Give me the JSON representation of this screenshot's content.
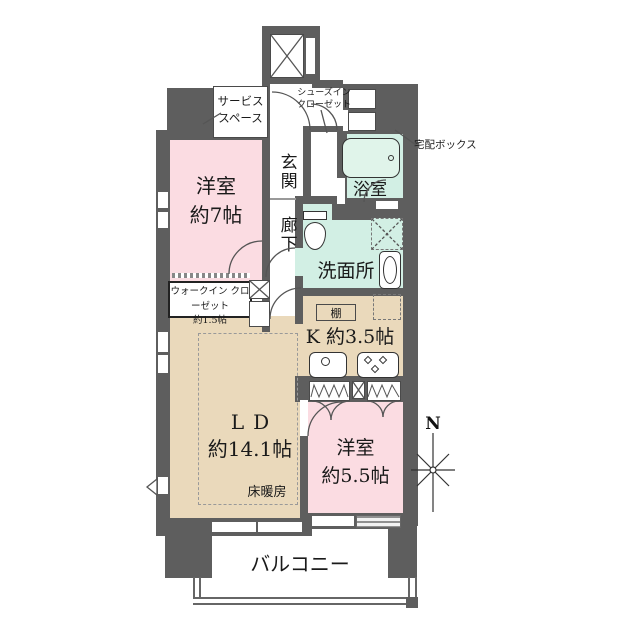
{
  "title": "apartment-floor-plan",
  "colors": {
    "wall": "#5e5e5e",
    "pink": "#fbdce2",
    "tan": "#ead9bb",
    "mint": "#d2efe4",
    "line": "#4a4a4a",
    "text": "#1a1a1a"
  },
  "labels": {
    "service_space": "サービス\nスペース",
    "shoes_in_closet": "シューズイン\nクローゼット",
    "entrance": "玄関",
    "delivery_box": "宅配ボックス",
    "bathroom": "浴室",
    "corridor": "廊下",
    "washroom": "洗面所",
    "bedroom_7": "洋室\n約7帖",
    "walk_in_closet": "ウォークイン クローゼット\n約1.5帖",
    "shelf": "棚",
    "kitchen": "K 約3.5帖",
    "ld_name": "LD",
    "ld_size": "約14.1帖",
    "floor_heating": "床暖房",
    "bedroom_5": "洋室\n約5.5帖",
    "balcony": "バルコニー",
    "compass_north": "N"
  }
}
